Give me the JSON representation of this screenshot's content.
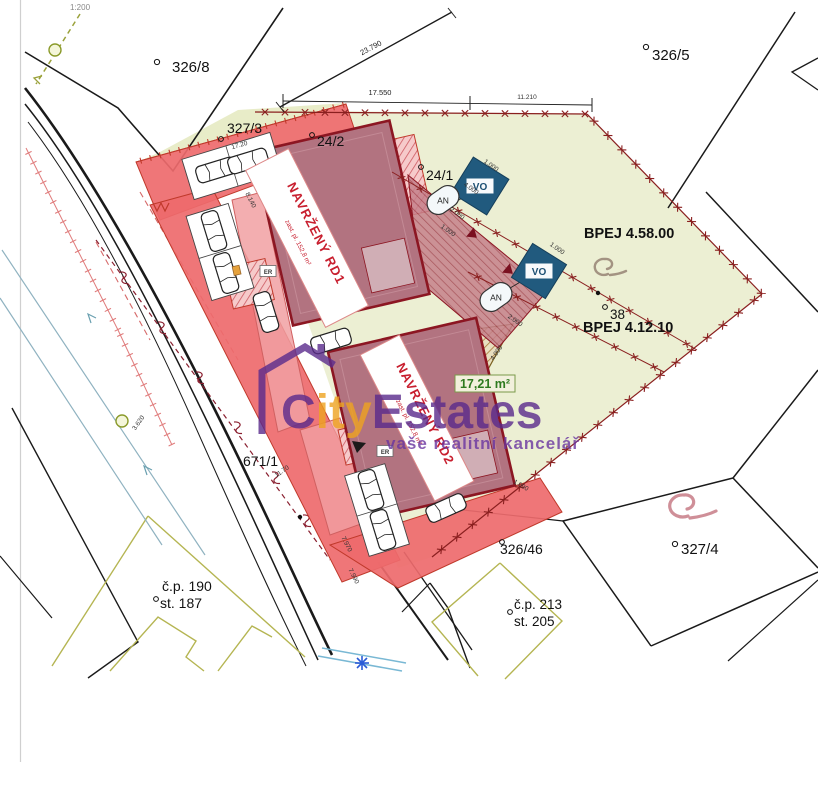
{
  "map": {
    "scale": "1:200"
  },
  "watermark": {
    "c": "C",
    "ity": "ity",
    "estates": "Estates",
    "tagline": "vaše realitní kancelář"
  },
  "parcels": {
    "p326_8": "326/8",
    "p326_5": "326/5",
    "p327_3": "327/3",
    "p24_2": "24/2",
    "p24_1": "24/1",
    "p38": "38",
    "p671_1": "671/1",
    "p326_46": "326/46",
    "p327_4": "327/4",
    "cp190": "č.p. 190",
    "st187": "st. 187",
    "cp213": "č.p. 213",
    "st205": "st. 205"
  },
  "soil": {
    "bpej_a": "BPEJ 4.58.00",
    "bpej_b": "BPEJ 4.12.10"
  },
  "buildings": {
    "rd1": "NAVRŽENÝ RD1",
    "rd1_sub": "zast. pl. 152,8 m²",
    "rd2": "NAVRŽENÝ RD2",
    "rd2_sub": "zast. pl. 152,8 m²"
  },
  "labels": {
    "area": "17,21 m²",
    "vo": "VO",
    "an": "AN",
    "er": "ER"
  },
  "dims": {
    "d23790": "23.790",
    "d17550": "17.550",
    "d11210": "11.210",
    "s17_20": "17.20",
    "s8140": "8.140",
    "s9440": "9.440",
    "s1000a": "1.000",
    "s2000a": "2.000",
    "s1000b": "1.000",
    "s1000c": "1.000",
    "s2000b": "2.000",
    "s4000a": "4.000",
    "s1090": "1.090",
    "s7970": "7.970",
    "s7990": "7.990",
    "s3620": "3.620",
    "s1170": "11.70",
    "s4000b": "4.000"
  },
  "colors": {
    "parcel_green": "#ecefd3",
    "road_red": "#ee6a6d",
    "building": "#b27380",
    "building_border": "#8c1622",
    "fence": "#8a1f1f",
    "vo_blue": "#215a7e",
    "watermark_purple": "#5a2a8c",
    "watermark_orange": "#eea320",
    "area_green": "#2f7a1f"
  }
}
